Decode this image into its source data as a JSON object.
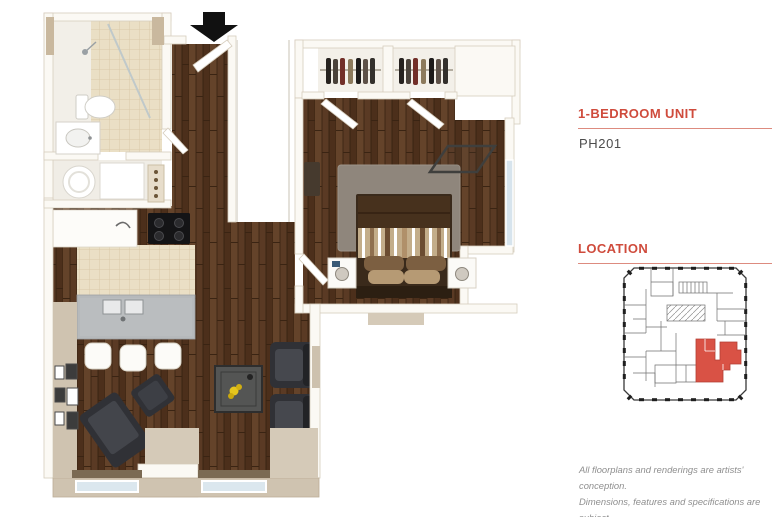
{
  "panel": {
    "unit_type_heading": "1-BEDROOM UNIT",
    "unit_number": "PH201",
    "location_heading": "LOCATION",
    "disclaimer_lines": [
      "All floorplans and renderings are artists' conception.",
      "Dimensions, features and specifications are subject",
      "to change at the discretion of the builder."
    ]
  },
  "colors": {
    "accent_red": "#cf4b3c",
    "heading_underline": "#dd8b7f",
    "map_highlight": "#d95245",
    "unit_number_text": "#4c4c4c",
    "disclaimer_text": "#8f8f8f"
  },
  "floorplan": {
    "entry_arrow_icon": "black-down-arrow",
    "regions": [
      "bathroom",
      "laundry-closet",
      "entry",
      "kitchen",
      "living-room",
      "bedroom",
      "closets",
      "bedroom-nook"
    ]
  }
}
